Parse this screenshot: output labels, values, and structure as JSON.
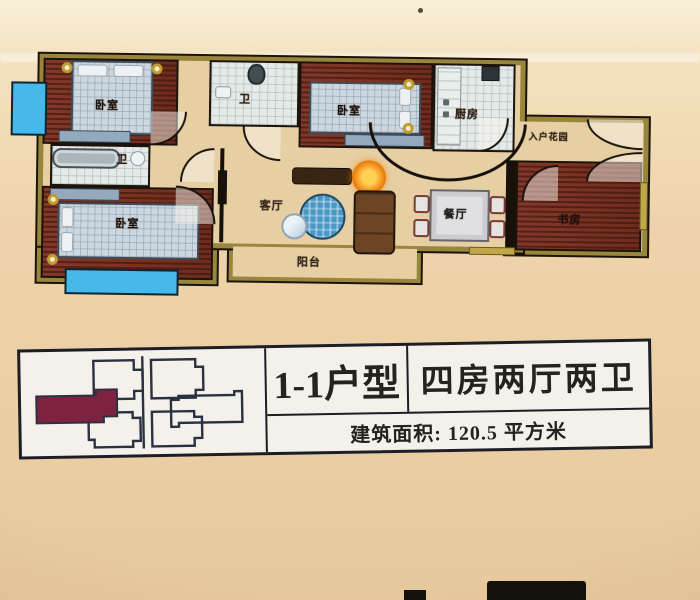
{
  "photo": {
    "type": "apartment floor plan photo",
    "background": {
      "top": "#f7ecd4",
      "middle": "#eed3aa",
      "bottom": "#e6c89c"
    }
  },
  "floor_plan": {
    "rooms": [
      {
        "name": "bedroom-top-left",
        "label": "卧室"
      },
      {
        "name": "bathroom-left",
        "label": "卫"
      },
      {
        "name": "bedroom-bottom-left",
        "label": "卧室"
      },
      {
        "name": "bathroom-middle",
        "label": "卫"
      },
      {
        "name": "bedroom-middle",
        "label": "卧室"
      },
      {
        "name": "kitchen",
        "label": "厨房"
      },
      {
        "name": "entry-garden",
        "label": "入户花园"
      },
      {
        "name": "living-room",
        "label": "客厅"
      },
      {
        "name": "dining-room",
        "label": "餐厅"
      },
      {
        "name": "study",
        "label": "书房"
      },
      {
        "name": "balcony",
        "label": "阳台"
      }
    ],
    "colors": {
      "wall": "#98863c",
      "wood_floor": "#7c3423",
      "hall_floor": "#e7cfa4",
      "tile_floor": "#e5e9e8",
      "bay_window": "#45b9ea"
    }
  },
  "legend": {
    "unit_name": "1-1户型",
    "unit_rooms": "四房两厅两卫",
    "area": "建筑面积: 120.5 平方米",
    "highlight_color": "#7d2340"
  }
}
